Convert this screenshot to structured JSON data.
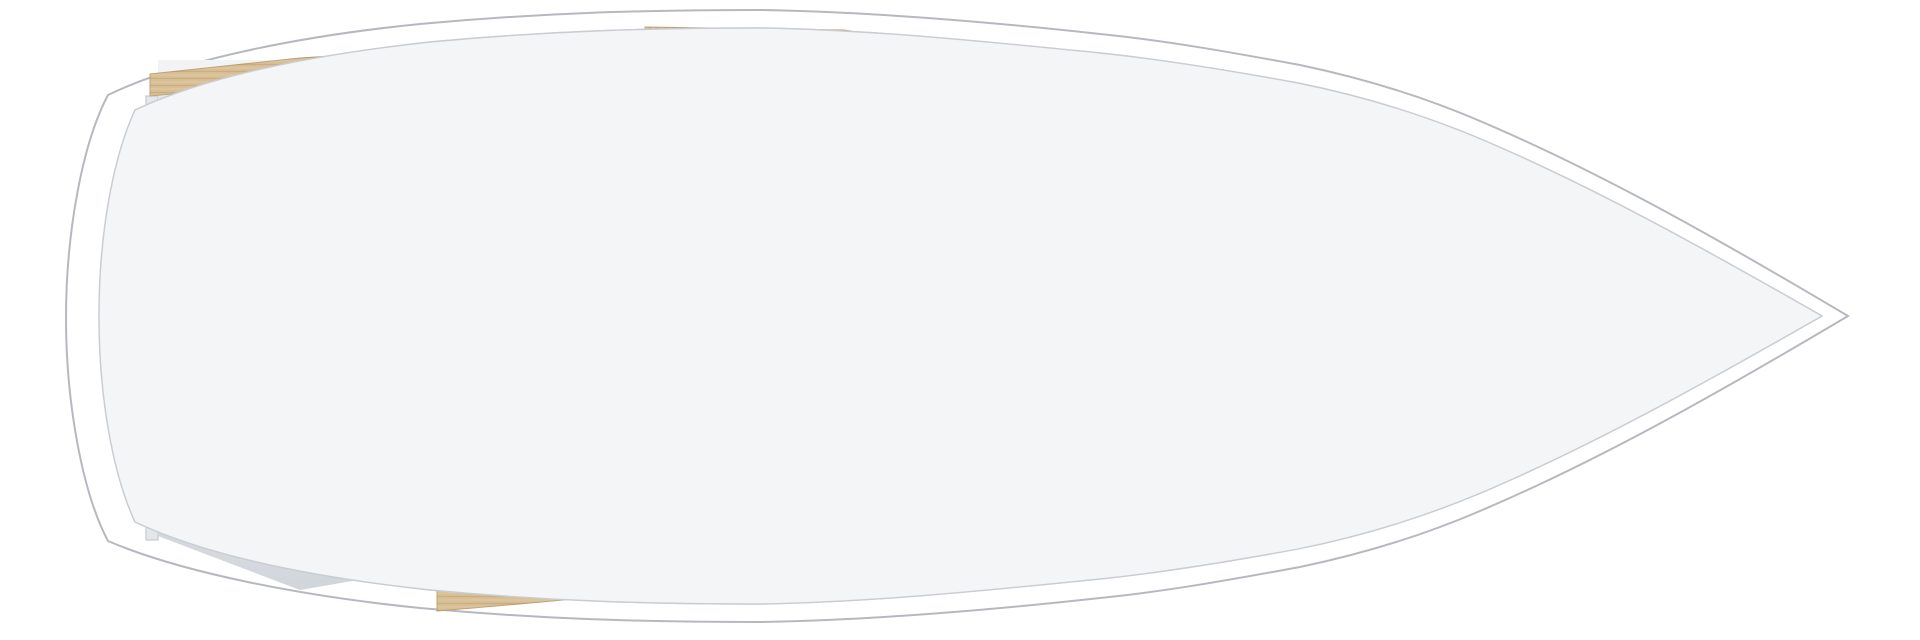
{
  "meta": {
    "title": "Sailboat interior floor plan (top view)",
    "orientation": "bow to the right, stern to the left",
    "style": "3D rendered architectural plan, no text labels"
  },
  "colors": {
    "hull_white": "#ffffff",
    "hull_line": "#b5b9bf",
    "deck": "#f3f5f7",
    "deck_line": "#c9cdd2",
    "wall": "#f2f4f6",
    "wall_shade": "#e3e7ea",
    "storage_floor": "#e2e6ea",
    "head_floor": "#eff2f4",
    "floor": "#7c5f4d",
    "wood": "#d9bf95",
    "wood_shadow": "#6f5b41",
    "desk_brown": "#6b4c39",
    "door_wood": "#6e4f3a",
    "linen": "#cbbeae",
    "runner": "#efe9dd",
    "bedding": "#f7f8fa",
    "fabric": "#d7c9b2",
    "fabric_light": "#e3d7c4",
    "counter": "#b2ada6",
    "counter_dark": "#a19c95",
    "sink_basin": "#8e959a",
    "steel_dark": "#3b3e42",
    "steel_mid": "#8e959c",
    "step_stripe": "#9a6a50",
    "table": "#e2cda3",
    "locker": "#fafbfc",
    "bag": "#f6f7f8"
  },
  "rooms": [
    {
      "name": "aft-cabin",
      "features": [
        "double-berth-linen-mattress",
        "cream-runner",
        "two-white-pillows",
        "chart-desk",
        "overhead-wood-lockers"
      ]
    },
    {
      "name": "aft-sail-locker",
      "features": [
        "large-sail-bag",
        "small-sail-bag"
      ]
    },
    {
      "name": "head",
      "features": [
        "toilet",
        "shower-drain",
        "teak-vent-grate",
        "vanity-basin-unit"
      ]
    },
    {
      "name": "galley",
      "features": [
        "two-burner-stove",
        "speckled-countertop",
        "double-sink",
        "faucet",
        "fridge-lift-top"
      ]
    },
    {
      "name": "companionway",
      "features": [
        "ladder-steps-four-treads",
        "shelf"
      ]
    },
    {
      "name": "salon",
      "features": [
        "port-settee-with-bolster",
        "starboard-settee",
        "corner-wedge-seat",
        "folding-table",
        "table-pedestal-knob",
        "two-door-cabinet",
        "plank-floor"
      ]
    },
    {
      "name": "forward-cabin",
      "features": [
        "v-berth-linen-mattress",
        "white-sheet",
        "two-white-pillows",
        "cream-runner",
        "entry-corridor",
        "sliding-door",
        "step-shelf",
        "wood-trim-rails"
      ]
    },
    {
      "name": "anchor-locker",
      "features": [
        "bow-compartment"
      ]
    }
  ]
}
